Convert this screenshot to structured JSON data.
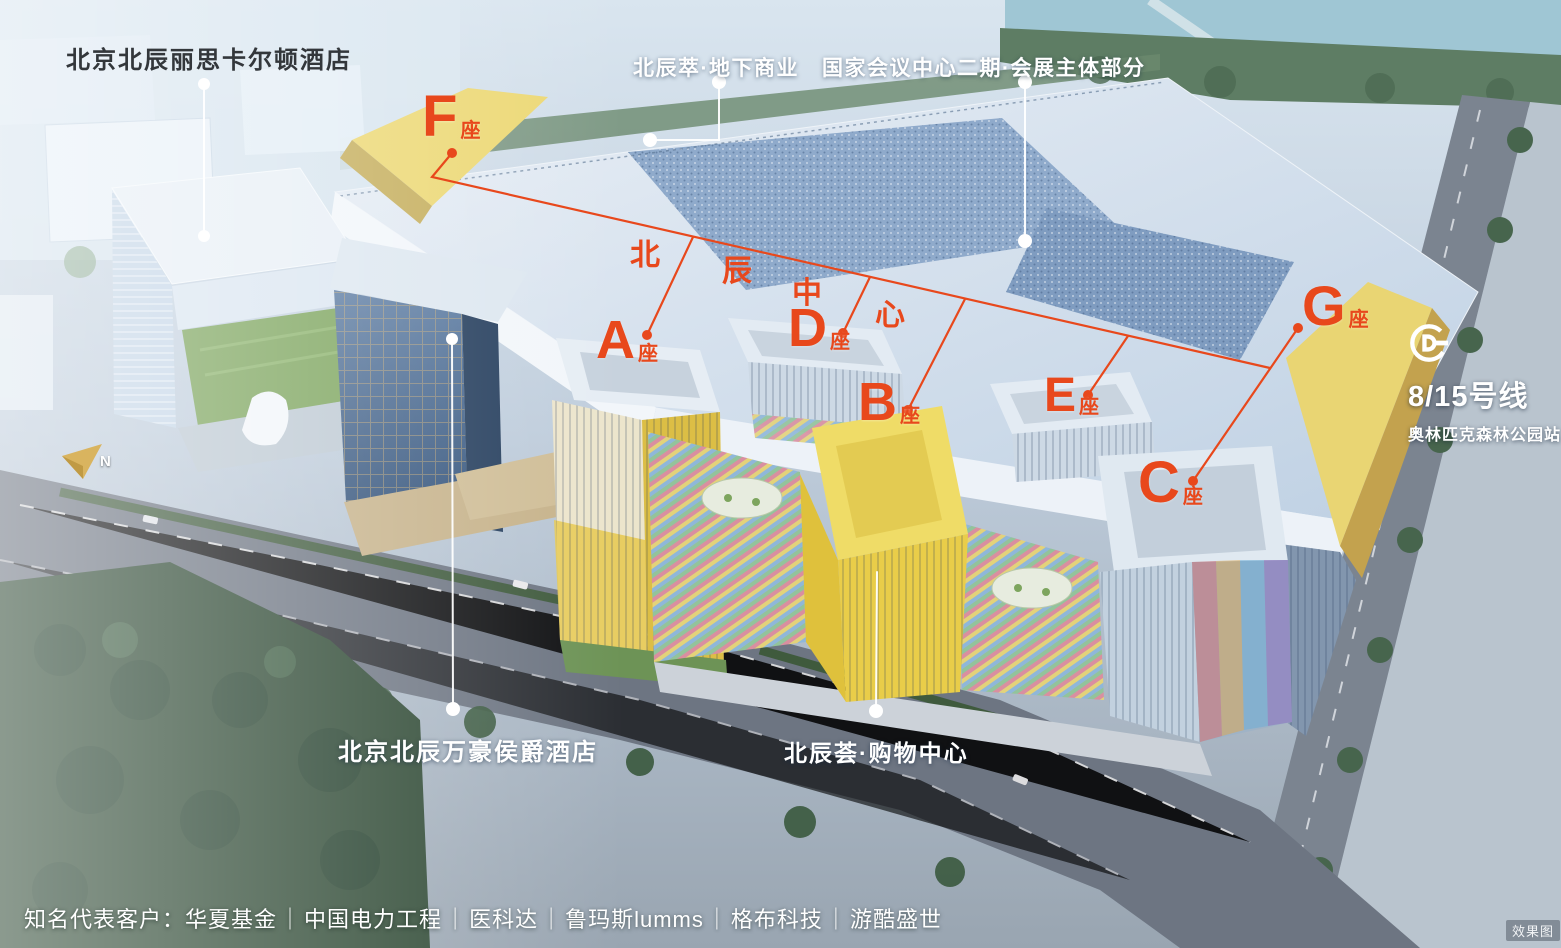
{
  "project": {
    "name": "北辰中心",
    "name_chars": [
      "北",
      "辰",
      "中",
      "心"
    ]
  },
  "annotations": {
    "ritz_carlton": "北京北辰丽思卡尔顿酒店",
    "underground_retail": "北辰萃·地下商业",
    "convention_center": "国家会议中心二期·会展主体部分",
    "marriott": "北京北辰万豪侯爵酒店",
    "shopping_mall": "北辰荟·购物中心"
  },
  "buildings": [
    {
      "id": "F",
      "letter": "F",
      "suffix": "座"
    },
    {
      "id": "A",
      "letter": "A",
      "suffix": "座"
    },
    {
      "id": "D",
      "letter": "D",
      "suffix": "座"
    },
    {
      "id": "B",
      "letter": "B",
      "suffix": "座"
    },
    {
      "id": "E",
      "letter": "E",
      "suffix": "座"
    },
    {
      "id": "C",
      "letter": "C",
      "suffix": "座"
    },
    {
      "id": "G",
      "letter": "G",
      "suffix": "座"
    }
  ],
  "subway": {
    "line": "8/15号线",
    "station": "奥林匹克森林公园站"
  },
  "compass": {
    "label": "N"
  },
  "clients": {
    "prefix": "知名代表客户：",
    "separator": "｜",
    "items": [
      "华夏基金",
      "中国电力工程",
      "医科达",
      "鲁玛斯lumms",
      "格布科技",
      "游酷盛世"
    ]
  },
  "watermark": "效果图",
  "colors": {
    "accent_orange": "#e8481c",
    "label_white": "#ffffff",
    "label_dark": "#33373b",
    "building_yellow": "#ecd874"
  }
}
